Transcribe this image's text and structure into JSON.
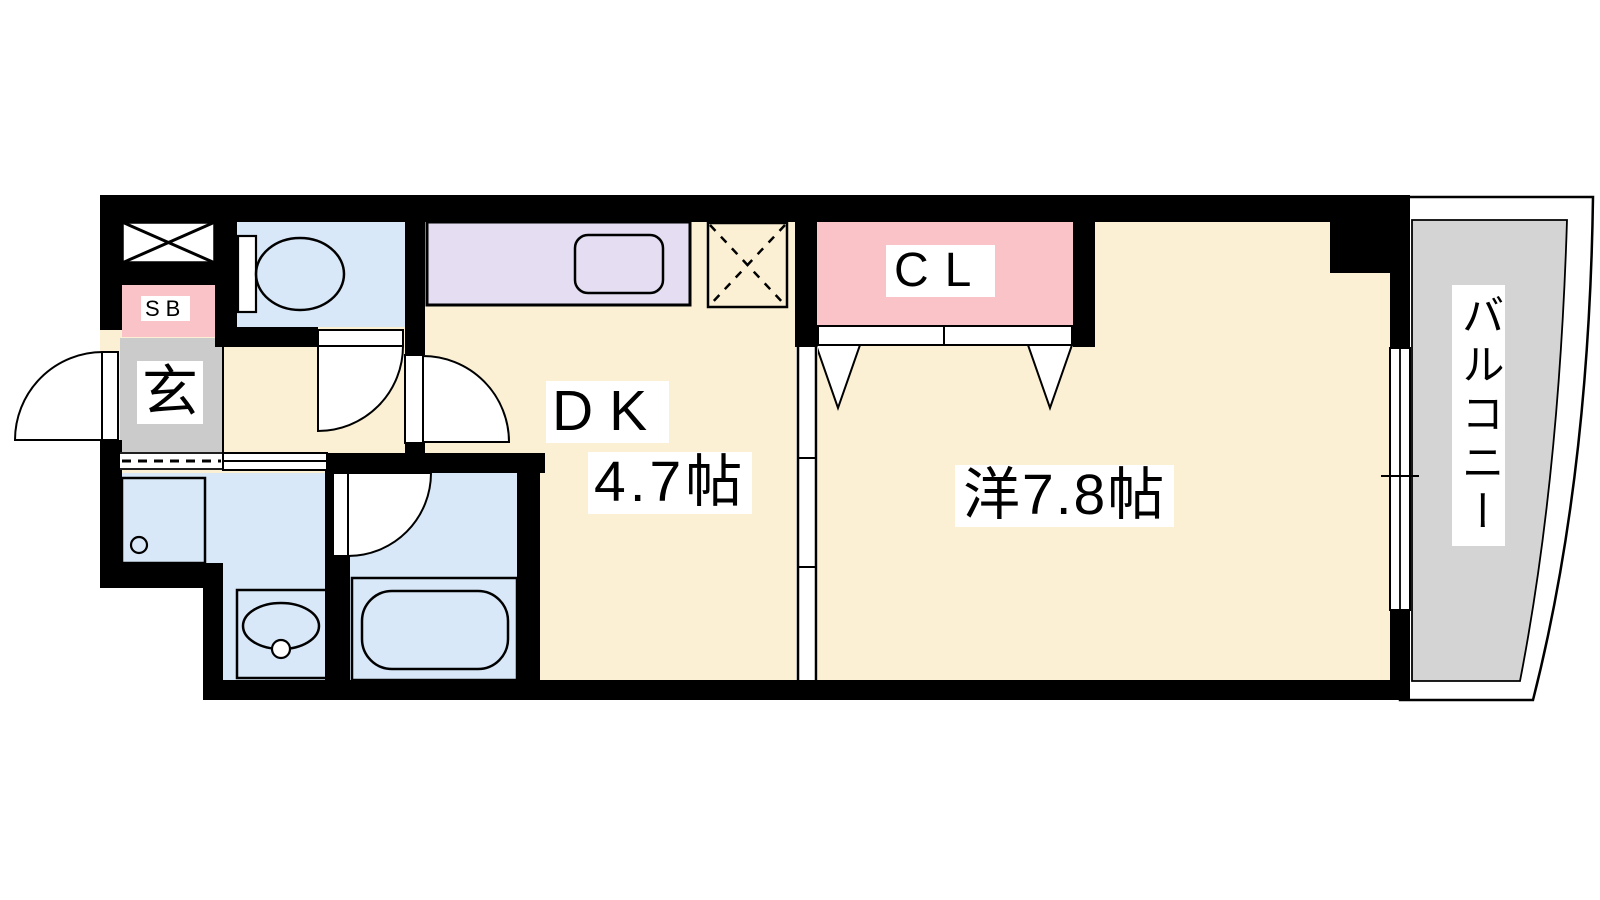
{
  "plan": {
    "title": "1DK apartment floor plan",
    "labels": {
      "shoe_box": "SB",
      "entrance": "玄",
      "dk": "DK",
      "dk_size": "4.7帖",
      "western_room": "洋7.8帖",
      "closet": "CL",
      "balcony": "バルコニー"
    },
    "colors": {
      "floor": "#FBF0D3",
      "wet_area": "#D8E8F8",
      "closet_pink": "#F9C3C7",
      "kitchen_counter": "#E5DDF1",
      "entrance_gray": "#CBCBCB",
      "balcony_gray": "#D4D4D4",
      "wall": "#000000",
      "line": "#000000"
    }
  }
}
